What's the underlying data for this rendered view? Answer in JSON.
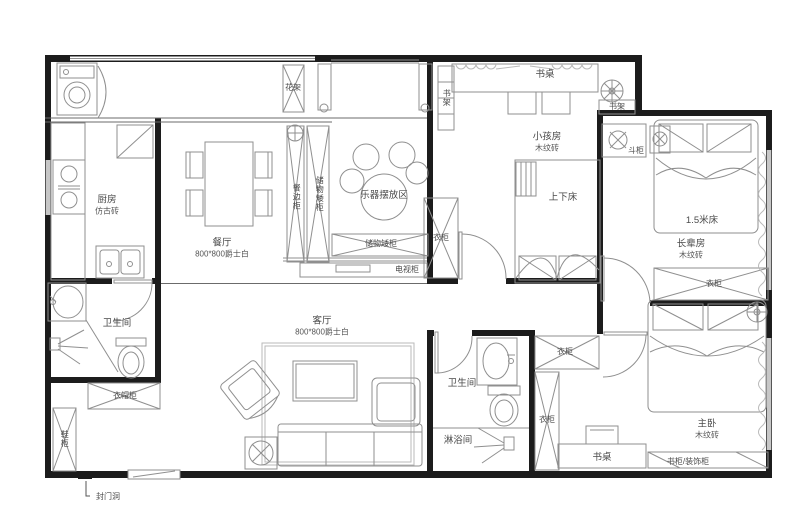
{
  "rooms": {
    "kitchen": {
      "name": "厨房",
      "floor": "仿古砖"
    },
    "dining": {
      "name": "餐厅",
      "floor": "800*800爵士白"
    },
    "living": {
      "name": "客厅",
      "floor": "800*800爵士白"
    },
    "kids": {
      "name": "小孩房",
      "floor": "木纹砖"
    },
    "elders": {
      "name": "长辈房",
      "floor": "木纹砖"
    },
    "master": {
      "name": "主卧",
      "floor": "木纹砖"
    },
    "bath_left": {
      "name": "卫生间"
    },
    "bath_right": {
      "name": "卫生间"
    },
    "shower": {
      "name": "淋浴间"
    }
  },
  "cabinets": {
    "flower_rack": "花架",
    "sideboard": "餐边柜",
    "storage_v": "储物矮柜",
    "instrument_area": "乐器摆放区",
    "storage_h": "储物矮柜",
    "tv_cabinet": "电视柜",
    "bookshelf_left": "书架",
    "kids_desk": "书桌",
    "bookshelf_right": "书架",
    "chest": "斗柜",
    "bunk_bed": "上下床",
    "kids_wardrobe": "衣柜",
    "elders_bed": "1.5米床",
    "elders_wardrobe": "衣柜",
    "cloak_cabinet": "衣帽柜",
    "shoe_cabinet": "鞋柜",
    "bath_wardrobe_top": "衣柜",
    "bath_wardrobe_side": "衣柜",
    "master_desk": "书桌",
    "master_bookcase": "书柜/装饰柜"
  },
  "annotations": {
    "seal_door": "封门洞"
  },
  "colors": {
    "wall": "#1c1c1c",
    "line": "#8f8f8f",
    "light": "#b9b9b9",
    "bg": "#ffffff"
  }
}
